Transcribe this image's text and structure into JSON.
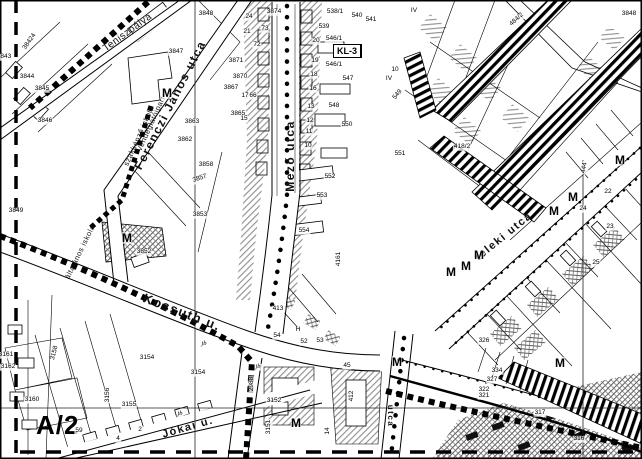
{
  "map": {
    "sheet_label": "A/2",
    "m_marker_glyph": "M",
    "street_labels": [
      {
        "text": "Ferenczi János utca",
        "x": 170,
        "y": 105,
        "rot": -63,
        "size": 12
      },
      {
        "text": "Mező utca",
        "x": 290,
        "y": 156,
        "rot": -90,
        "size": 12
      },
      {
        "text": "Kossuth u.",
        "x": 182,
        "y": 312,
        "rot": 21,
        "size": 13
      },
      {
        "text": "Jókai u.",
        "x": 188,
        "y": 428,
        "rot": -16,
        "size": 11
      },
      {
        "text": "teleki utca",
        "x": 504,
        "y": 237,
        "rot": -39,
        "size": 11
      },
      {
        "text": "utca",
        "x": 390,
        "y": 416,
        "rot": 90,
        "size": 8
      }
    ],
    "place_labels": [
      {
        "text": "Teniszpálya",
        "x": 128,
        "y": 33,
        "rot": -36,
        "size": 10
      },
      {
        "text": "Vendéglátóipari",
        "x": 151,
        "y": 124,
        "rot": -66,
        "size": 7.5
      },
      {
        "text": "szakképző iskola",
        "x": 139,
        "y": 136,
        "rot": -66,
        "size": 7.5
      },
      {
        "text": "általános iskola",
        "x": 80,
        "y": 252,
        "rot": -64,
        "size": 7.5
      }
    ],
    "zone_boxes": [
      {
        "id": "kl3-top",
        "label": "KL-3",
        "x": 333,
        "y": 44,
        "cells": [
          [
            "Z",
            "40"
          ],
          [
            "300",
            "K"
          ]
        ]
      },
      {
        "id": "kl3-left",
        "label": "KL-3",
        "x": 206,
        "y": 119,
        "cells": [
          [
            "Z",
            "40"
          ],
          [
            "300",
            "K"
          ]
        ]
      },
      {
        "id": "kl2-top",
        "label": "KL-2",
        "x": 448,
        "y": 98,
        "cells": [
          [
            "Z",
            "40"
          ],
          [
            "300",
            "K"
          ]
        ]
      },
      {
        "id": "kl1-left",
        "label": "KL-1",
        "x": 96,
        "y": 201,
        "cells": [
          [
            "Z",
            "60"
          ],
          [
            "K",
            "K"
          ]
        ]
      },
      {
        "id": "kl4",
        "label": "KL-4",
        "x": 155,
        "y": 222,
        "cells": [
          [
            "Z",
            "5965/5"
          ],
          [
            "K",
            "K-9,5"
          ]
        ]
      },
      {
        "id": "kl1-mid",
        "label": "KL-1",
        "x": 362,
        "y": 278,
        "cells": [
          [
            "Z",
            "60"
          ],
          [
            "K",
            "K"
          ]
        ]
      },
      {
        "id": "kl1-bottom",
        "label": "KL-1",
        "x": 324,
        "y": 403,
        "cells": [
          [
            "Z",
            "60"
          ],
          [
            "K",
            "K"
          ]
        ]
      },
      {
        "id": "kl1-right",
        "label": "KL-1",
        "x": 588,
        "y": 250,
        "cells": [
          [
            "Z",
            "60"
          ],
          [
            "K",
            "K"
          ]
        ]
      },
      {
        "id": "kl2-right",
        "label": "KL-2",
        "x": 597,
        "y": 380,
        "cells": [
          [
            "Z·H",
            "350"
          ],
          [
            "60",
            "K-7,5"
          ]
        ]
      },
      {
        "id": "kl2-bottom",
        "label": "KL-2",
        "x": 527,
        "y": 419,
        "cells": [
          [
            "Z·H",
            "700"
          ],
          [
            "60",
            "K-7,5"
          ]
        ]
      },
      {
        "id": "kp",
        "label": "KP",
        "x": 434,
        "y": 389,
        "big": true,
        "cells": []
      },
      {
        "id": "top-partial",
        "label": "Á-(189)",
        "x": 519,
        "y": 1,
        "tiny": true,
        "cells": []
      }
    ],
    "m_markers": [
      {
        "x": 167,
        "y": 93
      },
      {
        "x": 127,
        "y": 238
      },
      {
        "x": 296,
        "y": 423
      },
      {
        "x": 397,
        "y": 362
      },
      {
        "x": 560,
        "y": 363
      },
      {
        "x": 479,
        "y": 255
      },
      {
        "x": 466,
        "y": 266
      },
      {
        "x": 451,
        "y": 272
      },
      {
        "x": 573,
        "y": 197
      },
      {
        "x": 554,
        "y": 211
      },
      {
        "x": 620,
        "y": 160
      }
    ],
    "parcel_labels": [
      {
        "t": "38424",
        "x": 30,
        "y": 42,
        "r": -55
      },
      {
        "t": "3843",
        "x": 4,
        "y": 57
      },
      {
        "t": "3844",
        "x": 27,
        "y": 77
      },
      {
        "t": "3845",
        "x": 42,
        "y": 89
      },
      {
        "t": "3846",
        "x": 45,
        "y": 121
      },
      {
        "t": "3847",
        "x": 176,
        "y": 52
      },
      {
        "t": "3848",
        "x": 206,
        "y": 14
      },
      {
        "t": "3849",
        "x": 16,
        "y": 211
      },
      {
        "t": "3848",
        "x": 629,
        "y": 14
      },
      {
        "t": "484/2",
        "x": 517,
        "y": 20,
        "r": -42
      },
      {
        "t": "418/2",
        "x": 462,
        "y": 147
      },
      {
        "t": "3874",
        "x": 274,
        "y": 12
      },
      {
        "t": "73",
        "x": 265,
        "y": 29
      },
      {
        "t": "72",
        "x": 257,
        "y": 45
      },
      {
        "t": "3871",
        "x": 236,
        "y": 61
      },
      {
        "t": "3870",
        "x": 240,
        "y": 77
      },
      {
        "t": "3867",
        "x": 231,
        "y": 88
      },
      {
        "t": "66",
        "x": 253,
        "y": 96
      },
      {
        "t": "3865",
        "x": 238,
        "y": 114
      },
      {
        "t": "3863",
        "x": 192,
        "y": 122
      },
      {
        "t": "3862",
        "x": 185,
        "y": 140
      },
      {
        "t": "538/1",
        "x": 335,
        "y": 12
      },
      {
        "t": "539",
        "x": 324,
        "y": 27
      },
      {
        "t": "540",
        "x": 357,
        "y": 16
      },
      {
        "t": "541",
        "x": 371,
        "y": 20
      },
      {
        "t": "546/1",
        "x": 334,
        "y": 39
      },
      {
        "t": "546/1",
        "x": 334,
        "y": 65
      },
      {
        "t": "547",
        "x": 348,
        "y": 79
      },
      {
        "t": "548",
        "x": 334,
        "y": 106
      },
      {
        "t": "549",
        "x": 398,
        "y": 95,
        "r": -50
      },
      {
        "t": "550",
        "x": 347,
        "y": 125
      },
      {
        "t": "551",
        "x": 400,
        "y": 154
      },
      {
        "t": "552",
        "x": 330,
        "y": 177
      },
      {
        "t": "553",
        "x": 322,
        "y": 196
      },
      {
        "t": "554",
        "x": 304,
        "y": 231
      },
      {
        "t": "4161",
        "x": 339,
        "y": 259,
        "r": -90
      },
      {
        "t": "3858",
        "x": 206,
        "y": 165
      },
      {
        "t": "3857",
        "x": 200,
        "y": 179,
        "r": -18
      },
      {
        "t": "3853",
        "x": 200,
        "y": 215
      },
      {
        "t": "3852",
        "x": 144,
        "y": 252
      },
      {
        "t": "3154",
        "x": 147,
        "y": 358
      },
      {
        "t": "3154",
        "x": 198,
        "y": 373
      },
      {
        "t": "3155",
        "x": 129,
        "y": 405
      },
      {
        "t": "3156",
        "x": 108,
        "y": 395,
        "r": -90
      },
      {
        "t": "3158",
        "x": 55,
        "y": 353,
        "r": -75
      },
      {
        "t": "3160",
        "x": 32,
        "y": 400
      },
      {
        "t": "3161",
        "x": 6,
        "y": 355
      },
      {
        "t": "3162",
        "x": 8,
        "y": 367
      },
      {
        "t": "3151",
        "x": 269,
        "y": 427,
        "r": -90
      },
      {
        "t": "3152",
        "x": 274,
        "y": 401
      },
      {
        "t": "2988",
        "x": 252,
        "y": 384,
        "r": -90
      },
      {
        "t": "412",
        "x": 352,
        "y": 396,
        "r": -90
      },
      {
        "t": "45",
        "x": 347,
        "y": 366
      },
      {
        "t": "14",
        "x": 328,
        "y": 431,
        "r": -90
      },
      {
        "t": "413",
        "x": 278,
        "y": 309
      },
      {
        "t": "54",
        "x": 277,
        "y": 336
      },
      {
        "t": "52",
        "x": 304,
        "y": 342
      },
      {
        "t": "53",
        "x": 320,
        "y": 341
      },
      {
        "t": "H",
        "x": 298,
        "y": 330
      },
      {
        "t": "IV",
        "x": 414,
        "y": 11
      },
      {
        "t": "IV",
        "x": 389,
        "y": 79
      },
      {
        "t": "10",
        "x": 395,
        "y": 70
      },
      {
        "t": "444",
        "x": 585,
        "y": 168,
        "r": -80
      },
      {
        "t": "326",
        "x": 484,
        "y": 341
      },
      {
        "t": "334",
        "x": 497,
        "y": 371
      },
      {
        "t": "327",
        "x": 492,
        "y": 380
      },
      {
        "t": "322",
        "x": 484,
        "y": 390
      },
      {
        "t": "321",
        "x": 484,
        "y": 396
      },
      {
        "t": "317",
        "x": 540,
        "y": 413
      },
      {
        "t": "316",
        "x": 579,
        "y": 439
      },
      {
        "t": "59",
        "x": 79,
        "y": 431
      },
      {
        "t": "4",
        "x": 118,
        "y": 439
      },
      {
        "t": "2",
        "x": 140,
        "y": 430
      },
      {
        "t": "22",
        "x": 608,
        "y": 192
      },
      {
        "t": "24",
        "x": 583,
        "y": 209
      },
      {
        "t": "23",
        "x": 610,
        "y": 227
      },
      {
        "t": "25",
        "x": 596,
        "y": 263
      },
      {
        "t": "24",
        "x": 249,
        "y": 17
      },
      {
        "t": "21",
        "x": 247,
        "y": 32
      },
      {
        "t": "20",
        "x": 316,
        "y": 41
      },
      {
        "t": "19",
        "x": 315,
        "y": 61
      },
      {
        "t": "18",
        "x": 314,
        "y": 75
      },
      {
        "t": "17",
        "x": 245,
        "y": 96
      },
      {
        "t": "16",
        "x": 313,
        "y": 89
      },
      {
        "t": "15",
        "x": 244,
        "y": 119
      },
      {
        "t": "13",
        "x": 311,
        "y": 107
      },
      {
        "t": "12",
        "x": 310,
        "y": 121
      },
      {
        "t": "11",
        "x": 309,
        "y": 132
      },
      {
        "t": "10",
        "x": 308,
        "y": 146
      },
      {
        "t": "jb",
        "x": 204,
        "y": 344,
        "i": 1
      },
      {
        "t": "jb",
        "x": 258,
        "y": 367,
        "i": 1
      },
      {
        "t": "jb",
        "x": 180,
        "y": 414,
        "i": 1
      }
    ]
  }
}
